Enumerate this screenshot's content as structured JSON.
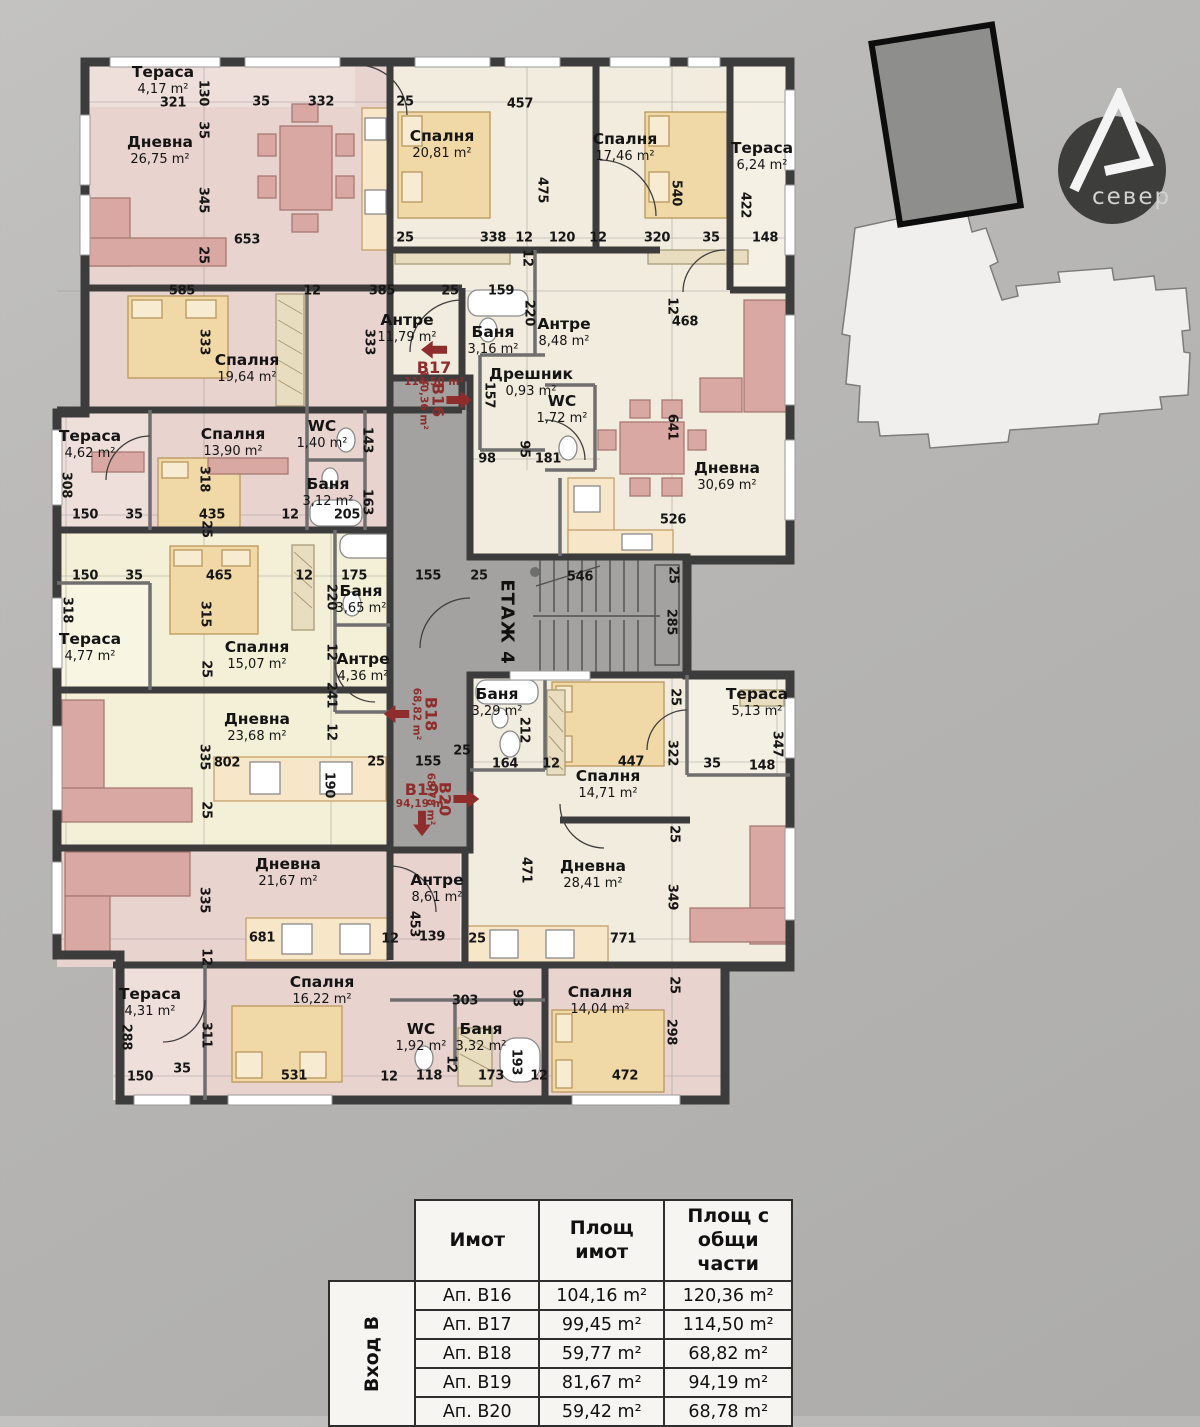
{
  "floor": {
    "label": "ЕТАЖ 4"
  },
  "logo": {
    "text": "север"
  },
  "plan": {
    "rooms": [
      {
        "n": "Тераса",
        "a": "4,17 m²",
        "x": 163,
        "y": 80
      },
      {
        "n": "Дневна",
        "a": "26,75 m²",
        "x": 160,
        "y": 150
      },
      {
        "n": "Спалня",
        "a": "20,81 m²",
        "x": 442,
        "y": 144
      },
      {
        "n": "Спалня",
        "a": "17,46 m²",
        "x": 625,
        "y": 147
      },
      {
        "n": "Тераса",
        "a": "6,24 m²",
        "x": 762,
        "y": 156
      },
      {
        "n": "Спалня",
        "a": "19,64 m²",
        "x": 247,
        "y": 368
      },
      {
        "n": "Антре",
        "a": "11,79 m²",
        "x": 407,
        "y": 328
      },
      {
        "n": "Баня",
        "a": "3,16 m²",
        "x": 493,
        "y": 340
      },
      {
        "n": "Антре",
        "a": "8,48 m²",
        "x": 564,
        "y": 332
      },
      {
        "n": "Дрешник",
        "a": "0,93 m²",
        "x": 531,
        "y": 382
      },
      {
        "n": "WC",
        "a": "1,72 m²",
        "x": 562,
        "y": 409
      },
      {
        "n": "Дневна",
        "a": "30,69 m²",
        "x": 727,
        "y": 476
      },
      {
        "n": "Тераса",
        "a": "4,62 m²",
        "x": 90,
        "y": 444
      },
      {
        "n": "Спалня",
        "a": "13,90 m²",
        "x": 233,
        "y": 442
      },
      {
        "n": "WC",
        "a": "1,40 m²",
        "x": 322,
        "y": 434
      },
      {
        "n": "Баня",
        "a": "3,12 m²",
        "x": 328,
        "y": 492
      },
      {
        "n": "Баня",
        "a": "3,65 m²",
        "x": 361,
        "y": 599
      },
      {
        "n": "Тераса",
        "a": "4,77 m²",
        "x": 90,
        "y": 647
      },
      {
        "n": "Спалня",
        "a": "15,07 m²",
        "x": 257,
        "y": 655
      },
      {
        "n": "Антре",
        "a": "4,36 m²",
        "x": 363,
        "y": 667
      },
      {
        "n": "Дневна",
        "a": "23,68 m²",
        "x": 257,
        "y": 727
      },
      {
        "n": "Баня",
        "a": "3,29 m²",
        "x": 497,
        "y": 702
      },
      {
        "n": "Спалня",
        "a": "14,71 m²",
        "x": 608,
        "y": 784
      },
      {
        "n": "Тераса",
        "a": "5,13 m²",
        "x": 757,
        "y": 702
      },
      {
        "n": "Дневна",
        "a": "28,41 m²",
        "x": 593,
        "y": 874
      },
      {
        "n": "Дневна",
        "a": "21,67 m²",
        "x": 288,
        "y": 872
      },
      {
        "n": "Антре",
        "a": "8,61 m²",
        "x": 437,
        "y": 888
      },
      {
        "n": "Спалня",
        "a": "16,22 m²",
        "x": 322,
        "y": 990
      },
      {
        "n": "Тераса",
        "a": "4,31 m²",
        "x": 150,
        "y": 1002
      },
      {
        "n": "WC",
        "a": "1,92 m²",
        "x": 421,
        "y": 1037
      },
      {
        "n": "Баня",
        "a": "3,32 m²",
        "x": 481,
        "y": 1037
      },
      {
        "n": "Спалня",
        "a": "14,04 m²",
        "x": 600,
        "y": 1000
      }
    ],
    "dims": [
      {
        "t": "321",
        "x": 173,
        "y": 103
      },
      {
        "t": "130",
        "x": 203,
        "y": 93,
        "v": 1
      },
      {
        "t": "35",
        "x": 261,
        "y": 102
      },
      {
        "t": "332",
        "x": 321,
        "y": 102
      },
      {
        "t": "25",
        "x": 405,
        "y": 102
      },
      {
        "t": "457",
        "x": 520,
        "y": 104
      },
      {
        "t": "35",
        "x": 203,
        "y": 130,
        "v": 1
      },
      {
        "t": "345",
        "x": 203,
        "y": 200,
        "v": 1
      },
      {
        "t": "25",
        "x": 203,
        "y": 255,
        "v": 1
      },
      {
        "t": "653",
        "x": 247,
        "y": 240
      },
      {
        "t": "475",
        "x": 542,
        "y": 190,
        "v": 1
      },
      {
        "t": "540",
        "x": 676,
        "y": 193,
        "v": 1
      },
      {
        "t": "422",
        "x": 745,
        "y": 205,
        "v": 1
      },
      {
        "t": "25",
        "x": 405,
        "y": 238
      },
      {
        "t": "338",
        "x": 493,
        "y": 238
      },
      {
        "t": "12",
        "x": 524,
        "y": 238
      },
      {
        "t": "120",
        "x": 562,
        "y": 238
      },
      {
        "t": "12",
        "x": 598,
        "y": 238
      },
      {
        "t": "320",
        "x": 657,
        "y": 238
      },
      {
        "t": "35",
        "x": 711,
        "y": 238
      },
      {
        "t": "148",
        "x": 765,
        "y": 238
      },
      {
        "t": "12",
        "x": 527,
        "y": 258,
        "v": 1
      },
      {
        "t": "585",
        "x": 182,
        "y": 291
      },
      {
        "t": "12",
        "x": 312,
        "y": 291
      },
      {
        "t": "385",
        "x": 382,
        "y": 291
      },
      {
        "t": "25",
        "x": 450,
        "y": 291
      },
      {
        "t": "159",
        "x": 501,
        "y": 291
      },
      {
        "t": "220",
        "x": 529,
        "y": 313,
        "v": 1
      },
      {
        "t": "12",
        "x": 672,
        "y": 306,
        "v": 1
      },
      {
        "t": "468",
        "x": 685,
        "y": 322
      },
      {
        "t": "333",
        "x": 204,
        "y": 342,
        "v": 1
      },
      {
        "t": "333",
        "x": 369,
        "y": 342,
        "v": 1
      },
      {
        "t": "157",
        "x": 489,
        "y": 395,
        "v": 1
      },
      {
        "t": "641",
        "x": 672,
        "y": 427,
        "v": 1
      },
      {
        "t": "98",
        "x": 487,
        "y": 459
      },
      {
        "t": "95",
        "x": 524,
        "y": 449,
        "v": 1
      },
      {
        "t": "181",
        "x": 548,
        "y": 459
      },
      {
        "t": "526",
        "x": 673,
        "y": 520
      },
      {
        "t": "143",
        "x": 367,
        "y": 440,
        "v": 1
      },
      {
        "t": "163",
        "x": 367,
        "y": 502,
        "v": 1
      },
      {
        "t": "205",
        "x": 347,
        "y": 515
      },
      {
        "t": "150",
        "x": 85,
        "y": 515
      },
      {
        "t": "35",
        "x": 134,
        "y": 515
      },
      {
        "t": "435",
        "x": 212,
        "y": 515
      },
      {
        "t": "12",
        "x": 290,
        "y": 515
      },
      {
        "t": "318",
        "x": 204,
        "y": 479,
        "v": 1
      },
      {
        "t": "25",
        "x": 206,
        "y": 529,
        "v": 1
      },
      {
        "t": "308",
        "x": 66,
        "y": 485,
        "v": 1
      },
      {
        "t": "150",
        "x": 85,
        "y": 576
      },
      {
        "t": "35",
        "x": 134,
        "y": 576
      },
      {
        "t": "465",
        "x": 219,
        "y": 576
      },
      {
        "t": "12",
        "x": 304,
        "y": 576
      },
      {
        "t": "175",
        "x": 354,
        "y": 576
      },
      {
        "t": "155",
        "x": 428,
        "y": 576
      },
      {
        "t": "25",
        "x": 479,
        "y": 576
      },
      {
        "t": "546",
        "x": 580,
        "y": 577
      },
      {
        "t": "25",
        "x": 673,
        "y": 575,
        "v": 1
      },
      {
        "t": "285",
        "x": 671,
        "y": 622,
        "v": 1
      },
      {
        "t": "318",
        "x": 67,
        "y": 610,
        "v": 1
      },
      {
        "t": "315",
        "x": 205,
        "y": 614,
        "v": 1
      },
      {
        "t": "220",
        "x": 331,
        "y": 597,
        "v": 1
      },
      {
        "t": "25",
        "x": 206,
        "y": 669,
        "v": 1
      },
      {
        "t": "12",
        "x": 331,
        "y": 652,
        "v": 1
      },
      {
        "t": "241",
        "x": 331,
        "y": 695,
        "v": 1
      },
      {
        "t": "12",
        "x": 331,
        "y": 732,
        "v": 1
      },
      {
        "t": "335",
        "x": 204,
        "y": 757,
        "v": 1
      },
      {
        "t": "802",
        "x": 227,
        "y": 763
      },
      {
        "t": "25",
        "x": 206,
        "y": 810,
        "v": 1
      },
      {
        "t": "190",
        "x": 329,
        "y": 785,
        "v": 1
      },
      {
        "t": "25",
        "x": 376,
        "y": 762
      },
      {
        "t": "155",
        "x": 428,
        "y": 762
      },
      {
        "t": "212",
        "x": 524,
        "y": 730,
        "v": 1
      },
      {
        "t": "25",
        "x": 462,
        "y": 751
      },
      {
        "t": "164",
        "x": 505,
        "y": 764
      },
      {
        "t": "12",
        "x": 551,
        "y": 764
      },
      {
        "t": "447",
        "x": 631,
        "y": 762
      },
      {
        "t": "322",
        "x": 672,
        "y": 753,
        "v": 1
      },
      {
        "t": "25",
        "x": 675,
        "y": 697,
        "v": 1
      },
      {
        "t": "35",
        "x": 712,
        "y": 764
      },
      {
        "t": "347",
        "x": 777,
        "y": 744,
        "v": 1
      },
      {
        "t": "148",
        "x": 762,
        "y": 766
      },
      {
        "t": "25",
        "x": 674,
        "y": 834,
        "v": 1
      },
      {
        "t": "471",
        "x": 526,
        "y": 870,
        "v": 1
      },
      {
        "t": "349",
        "x": 672,
        "y": 897,
        "v": 1
      },
      {
        "t": "771",
        "x": 623,
        "y": 939
      },
      {
        "t": "25",
        "x": 674,
        "y": 985,
        "v": 1
      },
      {
        "t": "298",
        "x": 671,
        "y": 1032,
        "v": 1
      },
      {
        "t": "472",
        "x": 625,
        "y": 1076
      },
      {
        "t": "335",
        "x": 204,
        "y": 900,
        "v": 1
      },
      {
        "t": "681",
        "x": 262,
        "y": 938
      },
      {
        "t": "12",
        "x": 206,
        "y": 957,
        "v": 1
      },
      {
        "t": "453",
        "x": 414,
        "y": 924,
        "v": 1
      },
      {
        "t": "12",
        "x": 390,
        "y": 939
      },
      {
        "t": "139",
        "x": 432,
        "y": 937
      },
      {
        "t": "25",
        "x": 477,
        "y": 939
      },
      {
        "t": "288",
        "x": 126,
        "y": 1037,
        "v": 1
      },
      {
        "t": "311",
        "x": 206,
        "y": 1035,
        "v": 1
      },
      {
        "t": "35",
        "x": 182,
        "y": 1069
      },
      {
        "t": "150",
        "x": 140,
        "y": 1077
      },
      {
        "t": "531",
        "x": 294,
        "y": 1076
      },
      {
        "t": "12",
        "x": 389,
        "y": 1077
      },
      {
        "t": "303",
        "x": 465,
        "y": 1001
      },
      {
        "t": "93",
        "x": 517,
        "y": 998,
        "v": 1
      },
      {
        "t": "12",
        "x": 451,
        "y": 1064,
        "v": 1
      },
      {
        "t": "193",
        "x": 516,
        "y": 1062,
        "v": 1
      },
      {
        "t": "118",
        "x": 429,
        "y": 1076
      },
      {
        "t": "173",
        "x": 491,
        "y": 1076
      },
      {
        "t": "12",
        "x": 539,
        "y": 1076
      }
    ],
    "markers": [
      {
        "id": "В17",
        "a": "114,50 m²",
        "x": 434,
        "y": 364,
        "v": 0,
        "arrow": "left",
        "icon_first": true
      },
      {
        "id": "В16",
        "a": "120,36 m²",
        "x": 445,
        "y": 400,
        "v": 1,
        "arrow": "up",
        "icon_first": true
      },
      {
        "id": "В18",
        "a": "68,82 m²",
        "x": 411,
        "y": 714,
        "v": 1,
        "arrow": "down",
        "icon_first": false
      },
      {
        "id": "В19",
        "a": "94,19 m²",
        "x": 422,
        "y": 809,
        "v": 0,
        "arrow": "down",
        "icon_first": false
      },
      {
        "id": "В20",
        "a": "68,78 m²",
        "x": 452,
        "y": 799,
        "v": 1,
        "arrow": "up",
        "icon_first": true
      }
    ]
  },
  "table": {
    "group_label": "Вход В",
    "headers": [
      "Имот",
      "Площ имот",
      "Площ с общи части"
    ],
    "rows": [
      {
        "unit": "Ап. В16",
        "area": "104,16 m²",
        "area_common": "120,36 m²"
      },
      {
        "unit": "Ап. В17",
        "area": "99,45 m²",
        "area_common": "114,50 m²"
      },
      {
        "unit": "Ап. В18",
        "area": "59,77 m²",
        "area_common": "68,82 m²"
      },
      {
        "unit": "Ап. В19",
        "area": "81,67 m²",
        "area_common": "94,19 m²"
      },
      {
        "unit": "Ап. В20",
        "area": "59,42 m²",
        "area_common": "68,78 m²"
      }
    ]
  }
}
